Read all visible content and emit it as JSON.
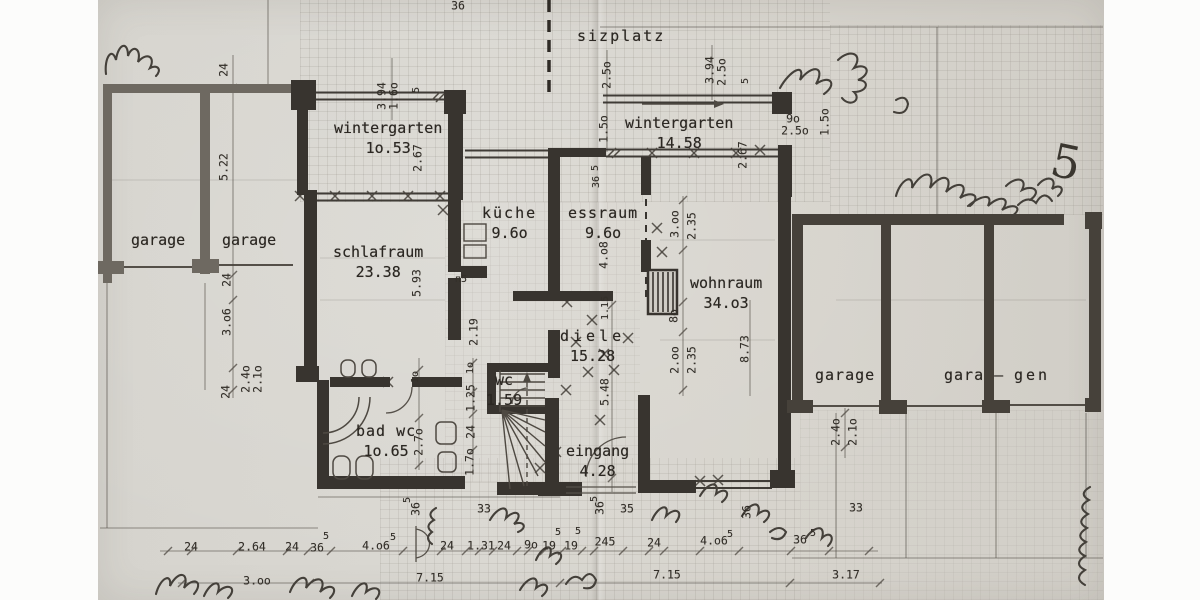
{
  "title": "ground floor plan scan",
  "colors": {
    "paper": "#d7d5cf",
    "wall_house": "#38342f",
    "wall_garage_left": "#6e6961",
    "wall_garage_right": "#46413a",
    "pencil": "#4e4942",
    "text": "#2b2722"
  },
  "rooms": [
    {
      "label": "sizplatz",
      "area": "",
      "x": 577,
      "y": 27,
      "ls": 2
    },
    {
      "label": "wintergarten",
      "area": "1o.53",
      "x": 334,
      "y": 119,
      "ls": 0
    },
    {
      "label": "wintergarten",
      "area": "14.58",
      "x": 625,
      "y": 114,
      "ls": 0
    },
    {
      "label": "garage",
      "area": "",
      "x": 131,
      "y": 231,
      "ls": 0
    },
    {
      "label": "garage",
      "area": "",
      "x": 222,
      "y": 231,
      "ls": 0
    },
    {
      "label": "schlafraum",
      "area": "23.38",
      "x": 333,
      "y": 243,
      "ls": 0
    },
    {
      "label": "küche",
      "area": "9.6o",
      "x": 482,
      "y": 204,
      "ls": 2
    },
    {
      "label": "essraum",
      "area": "9.6o",
      "x": 568,
      "y": 204,
      "ls": 1
    },
    {
      "label": "wohnraum",
      "area": "34.o3",
      "x": 690,
      "y": 274,
      "ls": 0
    },
    {
      "label": "diele",
      "area": "15.28",
      "x": 560,
      "y": 327,
      "ls": 4
    },
    {
      "label": "wc",
      "area": "1.59",
      "x": 486,
      "y": 371,
      "ls": 0
    },
    {
      "label": "bad wc",
      "area": "1o.65",
      "x": 356,
      "y": 422,
      "ls": 1
    },
    {
      "label": "eingang",
      "area": "4.28",
      "x": 566,
      "y": 442,
      "ls": 0
    },
    {
      "label": "garage",
      "area": "",
      "x": 815,
      "y": 366,
      "ls": 1
    },
    {
      "label": "gara –",
      "area": "",
      "x": 944,
      "y": 366,
      "ls": 1
    },
    {
      "label": "gen",
      "area": "",
      "x": 1014,
      "y": 366,
      "ls": 3
    }
  ],
  "dims": [
    {
      "t": "36",
      "x": 458,
      "y": 6
    },
    {
      "t": "3.94",
      "x": 382,
      "y": 96,
      "r": -90
    },
    {
      "t": "1.6o",
      "x": 394,
      "y": 96,
      "r": -90
    },
    {
      "t": "5",
      "x": 417,
      "y": 90,
      "r": -90,
      "s": 10
    },
    {
      "t": "2.67",
      "x": 418,
      "y": 158,
      "r": -90
    },
    {
      "t": "2.5o",
      "x": 607,
      "y": 75,
      "r": -90
    },
    {
      "t": "1.5o",
      "x": 604,
      "y": 129,
      "r": -90
    },
    {
      "t": "3.94",
      "x": 710,
      "y": 70,
      "r": -90
    },
    {
      "t": "2.5o",
      "x": 722,
      "y": 72,
      "r": -90
    },
    {
      "t": "5",
      "x": 746,
      "y": 81,
      "r": -90,
      "s": 10
    },
    {
      "t": "2.67",
      "x": 743,
      "y": 155,
      "r": -90
    },
    {
      "t": "9o",
      "x": 793,
      "y": 119
    },
    {
      "t": "2.5o",
      "x": 795,
      "y": 131
    },
    {
      "t": "1.5o",
      "x": 825,
      "y": 122,
      "r": -90
    },
    {
      "t": "24",
      "x": 224,
      "y": 70,
      "r": -90
    },
    {
      "t": "5.22",
      "x": 224,
      "y": 167,
      "r": -90
    },
    {
      "t": "24",
      "x": 227,
      "y": 280,
      "r": -90
    },
    {
      "t": "3.o6",
      "x": 227,
      "y": 322,
      "r": -90
    },
    {
      "t": "24",
      "x": 226,
      "y": 392,
      "r": -90
    },
    {
      "t": "2.4o",
      "x": 246,
      "y": 379,
      "r": -90
    },
    {
      "t": "2.1o",
      "x": 258,
      "y": 379,
      "r": -90
    },
    {
      "t": "5.93",
      "x": 417,
      "y": 283,
      "r": -90
    },
    {
      "t": "п5",
      "x": 461,
      "y": 280,
      "s": 10
    },
    {
      "t": "2.19",
      "x": 474,
      "y": 332,
      "r": -90
    },
    {
      "t": "1o",
      "x": 416,
      "y": 377,
      "r": -90,
      "s": 10
    },
    {
      "t": "1o",
      "x": 471,
      "y": 368,
      "r": -90,
      "s": 10
    },
    {
      "t": "1.25",
      "x": 471,
      "y": 398,
      "r": -90
    },
    {
      "t": "24",
      "x": 471,
      "y": 432,
      "r": -90
    },
    {
      "t": "2.7o",
      "x": 419,
      "y": 442,
      "r": -90
    },
    {
      "t": "1.7o",
      "x": 470,
      "y": 462,
      "r": -90
    },
    {
      "t": "5",
      "x": 408,
      "y": 500,
      "r": -90,
      "s": 10
    },
    {
      "t": "36",
      "x": 416,
      "y": 509,
      "r": -90
    },
    {
      "t": "33",
      "x": 484,
      "y": 509
    },
    {
      "t": "5.48",
      "x": 605,
      "y": 392,
      "r": -90
    },
    {
      "t": "4.o8",
      "x": 604,
      "y": 255,
      "r": -90
    },
    {
      "t": "1.15",
      "x": 606,
      "y": 308,
      "r": -90,
      "s": 10
    },
    {
      "t": "5",
      "x": 596,
      "y": 168,
      "r": -90,
      "s": 10
    },
    {
      "t": "36",
      "x": 597,
      "y": 182,
      "r": -90,
      "s": 10
    },
    {
      "t": "36",
      "x": 600,
      "y": 508,
      "r": -90
    },
    {
      "t": "5",
      "x": 595,
      "y": 499,
      "r": -90,
      "s": 10
    },
    {
      "t": "35",
      "x": 627,
      "y": 509
    },
    {
      "t": "3.oo",
      "x": 675,
      "y": 224,
      "r": -90
    },
    {
      "t": "2.35",
      "x": 692,
      "y": 226,
      "r": -90
    },
    {
      "t": "8o",
      "x": 674,
      "y": 316,
      "r": -90
    },
    {
      "t": "2.oo",
      "x": 675,
      "y": 360,
      "r": -90
    },
    {
      "t": "2.35",
      "x": 692,
      "y": 360,
      "r": -90
    },
    {
      "t": "8.73",
      "x": 745,
      "y": 349,
      "r": -90
    },
    {
      "t": "36",
      "x": 747,
      "y": 512,
      "r": -90
    },
    {
      "t": "33",
      "x": 856,
      "y": 508
    },
    {
      "t": "2.4o",
      "x": 836,
      "y": 432,
      "r": -90
    },
    {
      "t": "2.1o",
      "x": 853,
      "y": 432,
      "r": -90
    },
    {
      "t": "24",
      "x": 191,
      "y": 547
    },
    {
      "t": "2.64",
      "x": 252,
      "y": 547
    },
    {
      "t": "24",
      "x": 292,
      "y": 547
    },
    {
      "t": "36",
      "x": 317,
      "y": 548
    },
    {
      "t": "5",
      "x": 326,
      "y": 537,
      "s": 10
    },
    {
      "t": "4.o6",
      "x": 376,
      "y": 546
    },
    {
      "t": "5",
      "x": 393,
      "y": 538,
      "s": 10
    },
    {
      "t": "24",
      "x": 447,
      "y": 546
    },
    {
      "t": "1.31",
      "x": 481,
      "y": 546
    },
    {
      "t": "24",
      "x": 504,
      "y": 546
    },
    {
      "t": "9o",
      "x": 531,
      "y": 545
    },
    {
      "t": "19",
      "x": 549,
      "y": 546
    },
    {
      "t": "5",
      "x": 558,
      "y": 533,
      "s": 10
    },
    {
      "t": "19",
      "x": 571,
      "y": 546
    },
    {
      "t": "5",
      "x": 578,
      "y": 532,
      "s": 10
    },
    {
      "t": "245",
      "x": 605,
      "y": 542
    },
    {
      "t": "24",
      "x": 654,
      "y": 543
    },
    {
      "t": "4.o6",
      "x": 714,
      "y": 541
    },
    {
      "t": "5",
      "x": 730,
      "y": 535,
      "s": 10
    },
    {
      "t": "36",
      "x": 800,
      "y": 540
    },
    {
      "t": "5",
      "x": 813,
      "y": 534,
      "s": 10
    },
    {
      "t": "3.oo",
      "x": 257,
      "y": 581
    },
    {
      "t": "7.15",
      "x": 430,
      "y": 578
    },
    {
      "t": "7.15",
      "x": 667,
      "y": 575
    },
    {
      "t": "3.17",
      "x": 846,
      "y": 575
    },
    {
      "t": "5",
      "x": 1066,
      "y": 162,
      "s": 46,
      "hand": true,
      "r": 12
    }
  ]
}
